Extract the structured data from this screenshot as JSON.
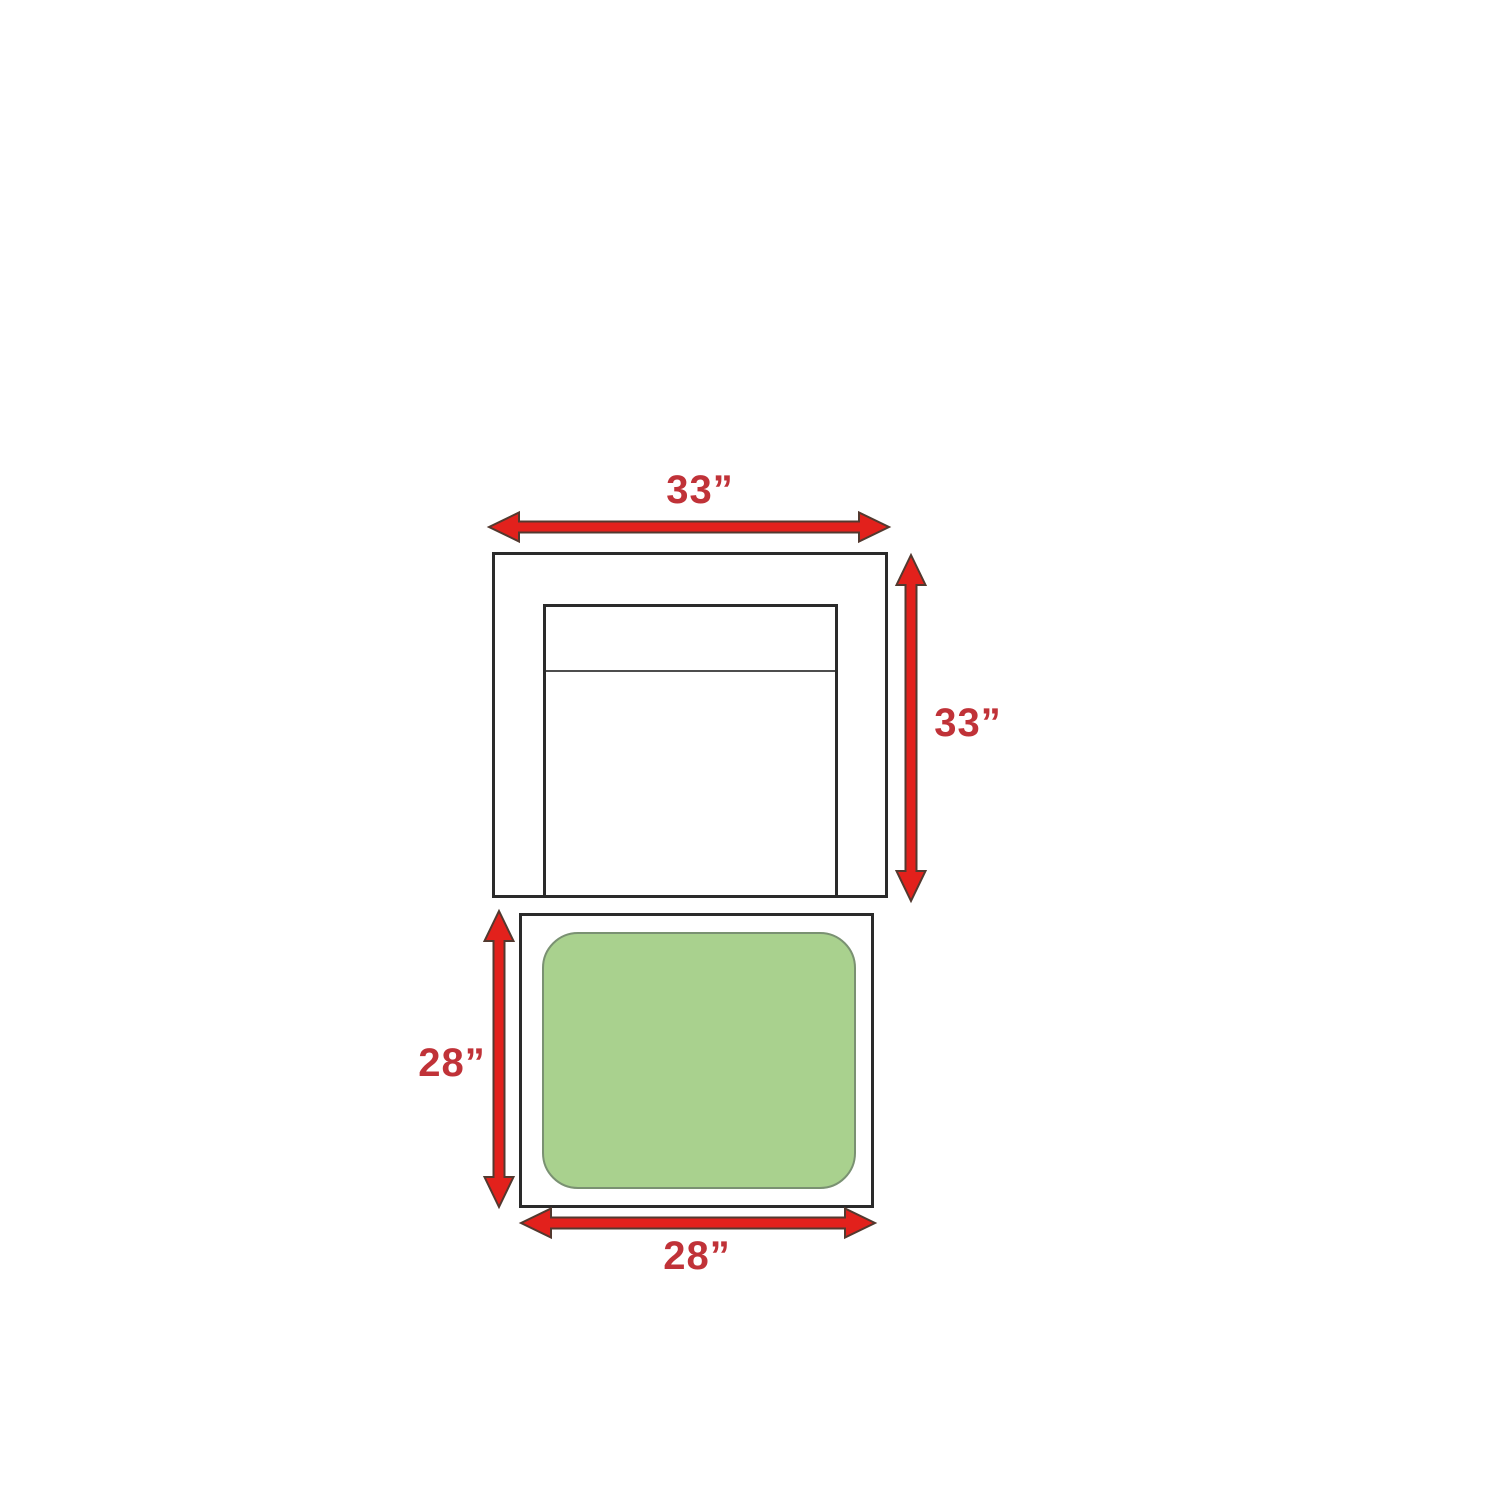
{
  "diagram": {
    "type": "furniture-dimension-diagram",
    "colors": {
      "background": "#ffffff",
      "arrow": "#e2211c",
      "arrow-outline": "#53392f",
      "label": "#c03238",
      "outline": "#2a2a2a",
      "divider": "#4d4d4d",
      "cushion": "#a9d18e",
      "cushion-border": "#7a9172"
    },
    "chair": {
      "width_label": "33”",
      "height_label": "33”"
    },
    "ottoman": {
      "height_label": "28”",
      "width_label": "28”"
    }
  }
}
